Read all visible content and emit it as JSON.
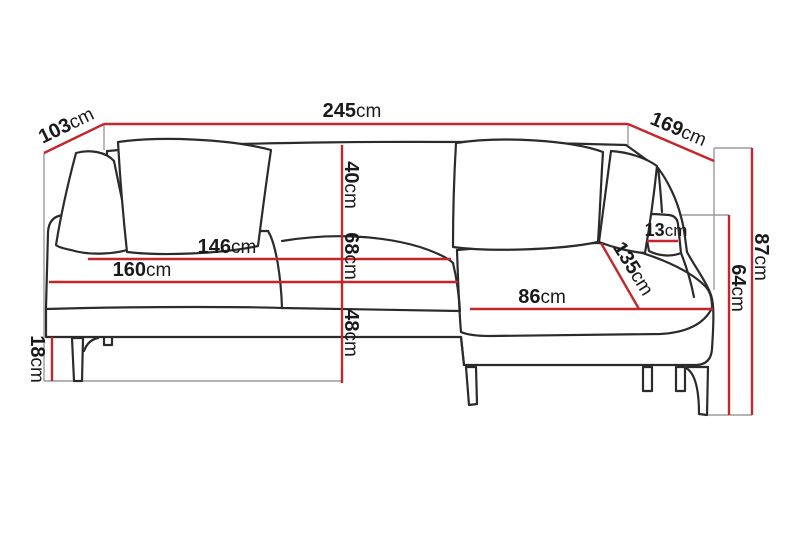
{
  "diagram": {
    "type": "furniture-dimension-diagram",
    "subject": "corner sofa with right chaise longue",
    "colors": {
      "dimension_line": "#c4262c",
      "guide_line": "#9b9b9b",
      "sofa_outline": "#2b2b2b",
      "text": "#1a1a1a",
      "background": "#ffffff"
    },
    "labels": {
      "total_width": {
        "value": "245",
        "unit": "cm"
      },
      "back_section_depth": {
        "value": "103",
        "unit": "cm"
      },
      "chaise_side_depth": {
        "value": "169",
        "unit": "cm"
      },
      "total_height": {
        "value": "87",
        "unit": "cm"
      },
      "arm_side_height": {
        "value": "64",
        "unit": "cm"
      },
      "backrest_height": {
        "value": "40",
        "unit": "cm"
      },
      "seat_depth": {
        "value": "68",
        "unit": "cm"
      },
      "seat_height": {
        "value": "48",
        "unit": "cm"
      },
      "inner_width": {
        "value": "146",
        "unit": "cm"
      },
      "seat_width": {
        "value": "160",
        "unit": "cm"
      },
      "leg_height": {
        "value": "18",
        "unit": "cm"
      },
      "armrest_width": {
        "value": "13",
        "unit": "cm"
      },
      "chaise_length": {
        "value": "135",
        "unit": "cm"
      },
      "chaise_seat_width": {
        "value": "86",
        "unit": "cm"
      }
    }
  }
}
